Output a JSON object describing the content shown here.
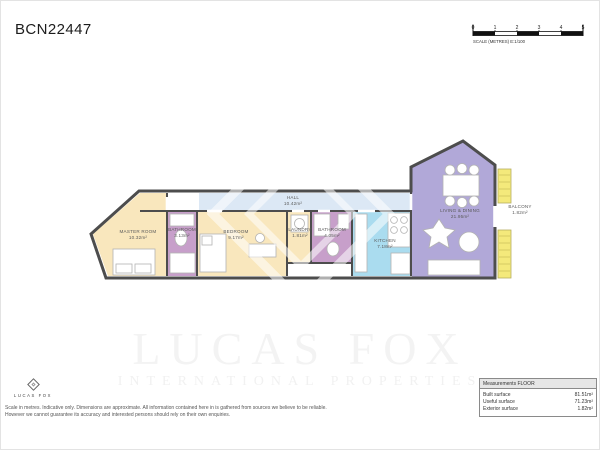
{
  "page": {
    "title": "BCN22447"
  },
  "scale_bar": {
    "ticks": [
      "0",
      "1",
      "2",
      "3",
      "4",
      "5"
    ],
    "label": "SCALE (METRES) E:1/100"
  },
  "floorplan": {
    "wall_color": "#4d4d4d",
    "rooms": [
      {
        "name": "MASTER ROOM",
        "area": "10.32m²",
        "color": "#f9e7bd"
      },
      {
        "name": "BATHROOM",
        "area": "3.13m²",
        "color": "#c79fca"
      },
      {
        "name": "BEDROOM",
        "area": "9.17m²",
        "color": "#f9e7bd"
      },
      {
        "name": "LAUNDRY",
        "area": "1.81m²",
        "color": "#f9e7bd"
      },
      {
        "name": "BATHROOM",
        "area": "4.05m²",
        "color": "#c79fca"
      },
      {
        "name": "HALL",
        "area": "10.42m²",
        "color": "#dce8f5"
      },
      {
        "name": "KITCHEN",
        "area": "7.18m²",
        "color": "#aadcef"
      },
      {
        "name": "LIVING & DINING",
        "area": "21.95m²",
        "color": "#b1a8d8"
      },
      {
        "name": "BALCONY",
        "area": "1.82m²",
        "color": "#f4e97b"
      }
    ]
  },
  "watermark": {
    "line1": "LUCAS FOX",
    "line2": "INTERNATIONAL PROPERTIES"
  },
  "footer": {
    "logo_text": "LUCAS FOX",
    "disclaimer_line1": "Scale in metres. Indicative only. Dimensions are approximate. All information contained here in is gathered from sources we believe to be reliable.",
    "disclaimer_line2": "However we cannot guarantee its accuracy and interested persons should rely on their own enquiries."
  },
  "measurements": {
    "header": "Measurements FLOOR",
    "rows": [
      {
        "label": "Built surface",
        "value": "81.51m²"
      },
      {
        "label": "Useful surface",
        "value": "71.23m²"
      },
      {
        "label": "Exterior surface",
        "value": "1.82m²"
      }
    ]
  }
}
